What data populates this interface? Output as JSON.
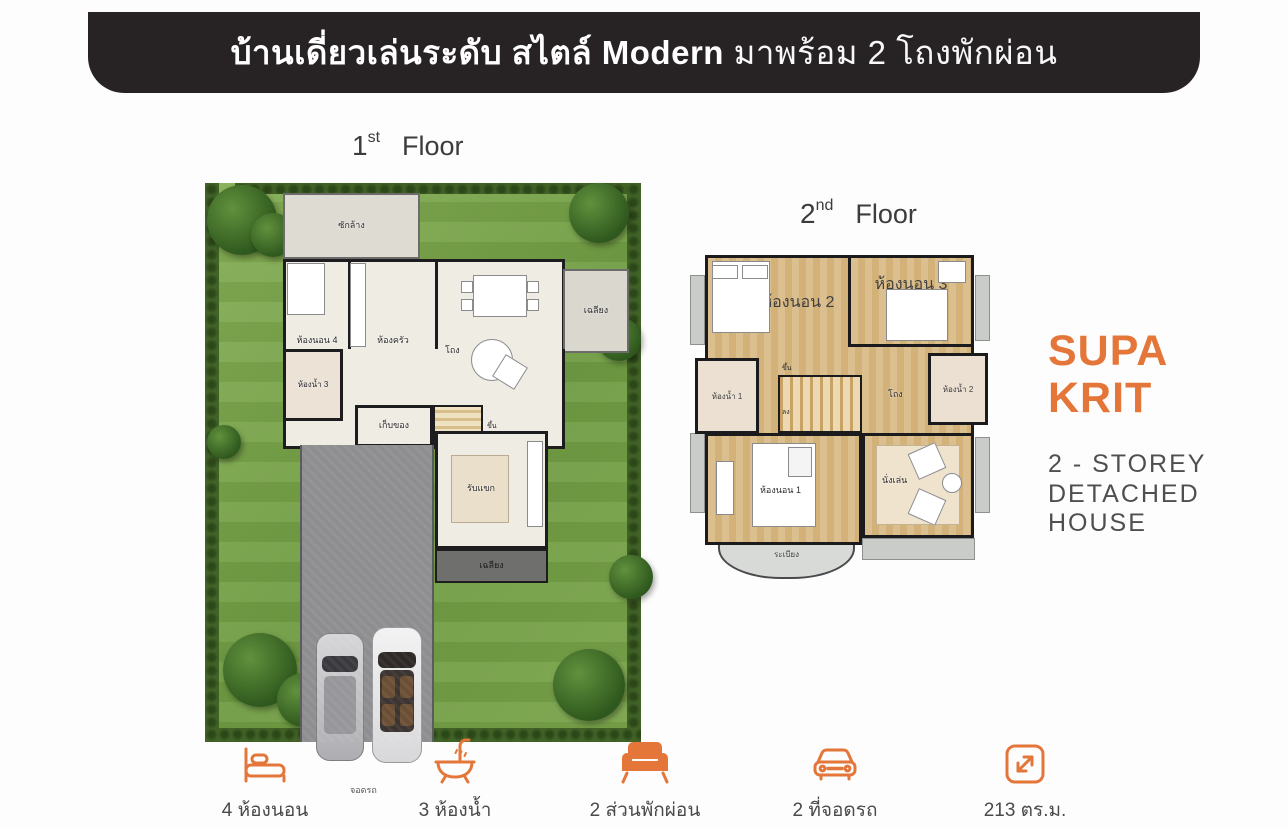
{
  "banner": {
    "title_bold": "บ้านเดี่ยวเล่นระดับ สไตล์ Modern",
    "title_tail": " มาพร้อม 2 โถงพักผ่อน",
    "bg": "#272324"
  },
  "floors": {
    "first": {
      "number": "1",
      "ordinal": "st",
      "word": "Floor",
      "rooms": {
        "laundry": "ซักล้าง",
        "bedroom4": "ห้องนอน 4",
        "kitchen": "ห้องครัว",
        "dining": "อาหาร",
        "porch_right": "เฉลียง",
        "bath3": "ห้องน้ำ 3",
        "hall": "โถง",
        "storage": "เก็บของ",
        "stairs": "ขึ้น",
        "living": "รับแขก",
        "porch_front": "เฉลียง",
        "parking": "จอดรถ"
      }
    },
    "second": {
      "number": "2",
      "ordinal": "nd",
      "word": "Floor",
      "rooms": {
        "bedroom2": "ห้องนอน 2",
        "bedroom3": "ห้องนอน 3",
        "bath1": "ห้องน้ำ 1",
        "bath2": "ห้องน้ำ 2",
        "hall": "โถง",
        "stairs_up": "ขึ้น",
        "stairs_down": "ลง",
        "bedroom1": "ห้องนอน 1",
        "sitting": "นั่งเล่น",
        "balcony": "ระเบียง"
      }
    }
  },
  "brand": {
    "name_line1": "SUPA",
    "name_line2": "KRIT",
    "color": "#E4763A",
    "subtitle_line1": "2 - STOREY",
    "subtitle_line2": "DETACHED",
    "subtitle_line3": "HOUSE"
  },
  "features": [
    {
      "icon": "bed-icon",
      "label": "4 ห้องนอน"
    },
    {
      "icon": "bathtub-icon",
      "label": "3 ห้องน้ำ"
    },
    {
      "icon": "sofa-icon",
      "label": "2 ส่วนพักผ่อน"
    },
    {
      "icon": "car-icon",
      "label": "2 ที่จอดรถ"
    },
    {
      "icon": "area-icon",
      "label": "213 ตร.ม."
    }
  ],
  "colors": {
    "accent": "#E4763A",
    "grass": "#7CA64C",
    "hedge": "#41611F",
    "wood": "#D9BA84",
    "driveway": "#8E8E90"
  }
}
